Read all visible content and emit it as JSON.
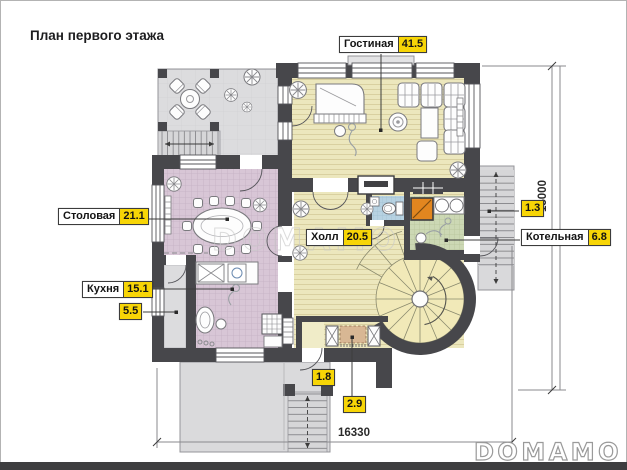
{
  "page": {
    "title": "План первого этажа",
    "watermark": "DOMAMO",
    "brand_logo": "DOMAMO"
  },
  "rooms": {
    "living": {
      "name": "Гостиная",
      "area": "41.5"
    },
    "dining": {
      "name": "Столовая",
      "area": "21.1"
    },
    "kitchen": {
      "name": "Кухня",
      "area": "15.1"
    },
    "hall": {
      "name": "Холл",
      "area": "20.5"
    },
    "boiler": {
      "name": "Котельная",
      "area": "6.8"
    },
    "pantry": {
      "area": "5.5"
    },
    "entry_landing": {
      "area": "1.3"
    },
    "vestibule": {
      "area": "1.8"
    },
    "porch": {
      "area": "2.9"
    }
  },
  "dimensions": {
    "width_mm": "16330",
    "height_mm": "15000"
  },
  "colors": {
    "wall": "#47474b",
    "label_value_bg": "#f7d506",
    "living_floor": "#ece7bd",
    "dining_floor": "#d8c6d6",
    "boiler_floor": "#ccd8b4",
    "wc_floor": "#b7d2e2",
    "terrace_floor": "#dcdcde",
    "furnace_accent": "#e2861f"
  }
}
